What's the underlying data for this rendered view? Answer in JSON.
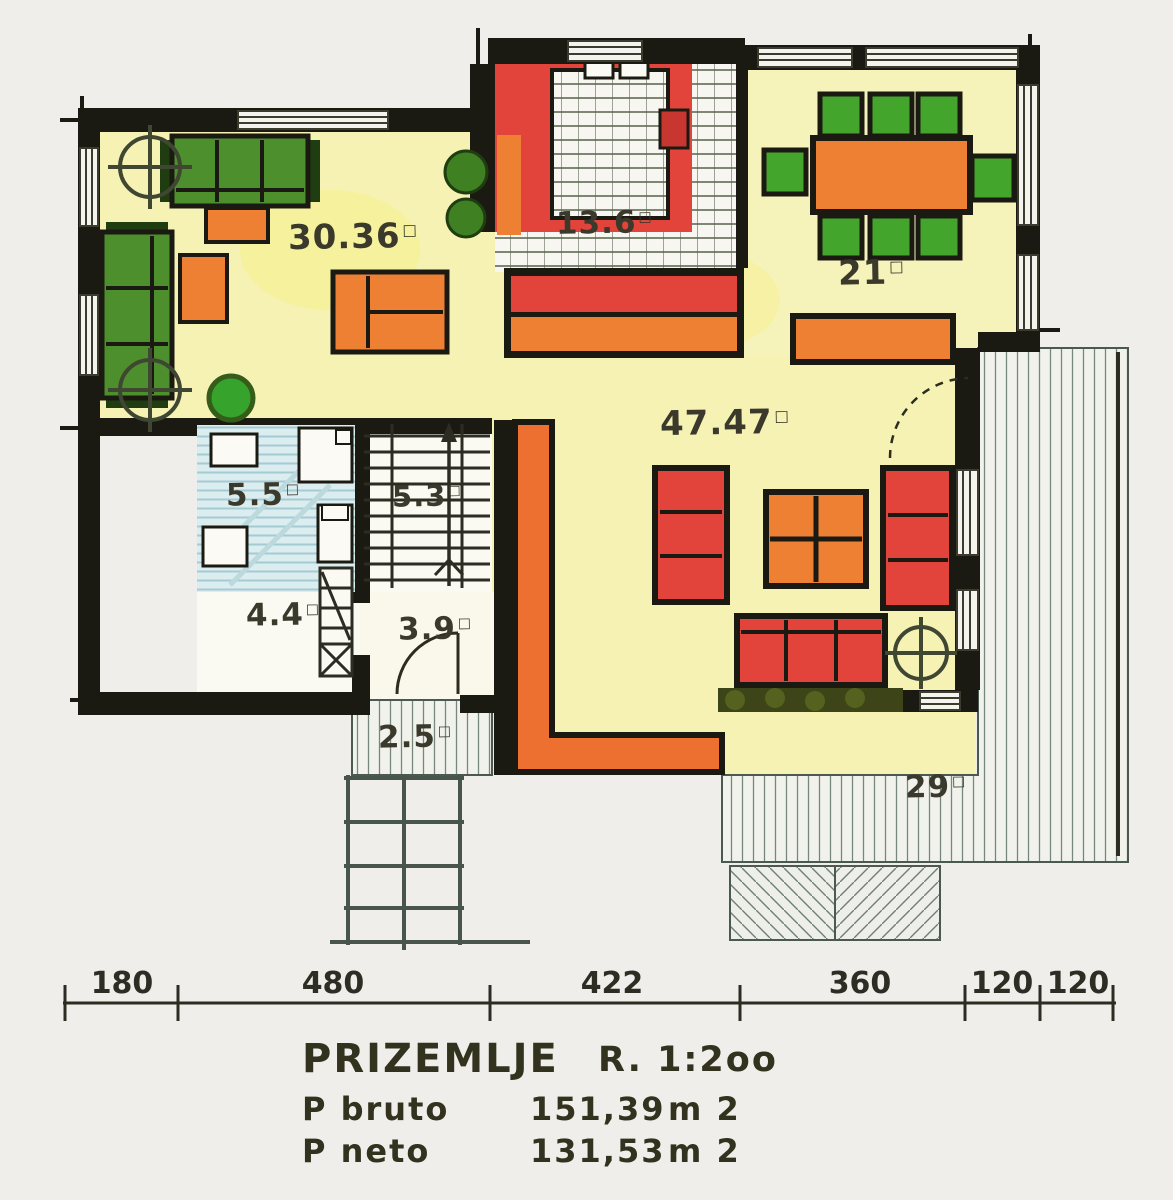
{
  "m2_symbol": "□",
  "rooms": {
    "living": {
      "name": "living-room",
      "area": "30.36"
    },
    "kitchen": {
      "name": "kitchen",
      "area": "13.6"
    },
    "dining": {
      "name": "dining-room",
      "area": "21"
    },
    "lounge": {
      "name": "living-area",
      "area": "47.47"
    },
    "bathroom": {
      "name": "bathroom",
      "area": "5.5"
    },
    "stairs": {
      "name": "staircase",
      "area": "5.3"
    },
    "wc": {
      "name": "storage-wc",
      "area": "4.4"
    },
    "hall": {
      "name": "hallway",
      "area": "3.9"
    },
    "entry": {
      "name": "entry-steps",
      "area": "2.5"
    },
    "terrace": {
      "name": "terrace",
      "area": "29"
    }
  },
  "dimensions": [
    "180",
    "480",
    "422",
    "360",
    "120",
    "120"
  ],
  "title_block": {
    "floor_name": "PRIZEMLJE",
    "scale": "R. 1:2oo",
    "bruto_label": "P  bruto",
    "bruto_value": "151,39",
    "bruto_unit": "m 2",
    "neto_label": "P  neto",
    "neto_value": "131,53",
    "neto_unit": "m 2"
  },
  "colors": {
    "wall": "#1a1a12",
    "floor_yellow": "#f5f2b4",
    "red": "#e2443b",
    "orange": "#ee8034",
    "green": "#4c8f2c",
    "bath_blue": "#d9ecee",
    "paper": "#efeeea",
    "text": "#3a392b"
  }
}
